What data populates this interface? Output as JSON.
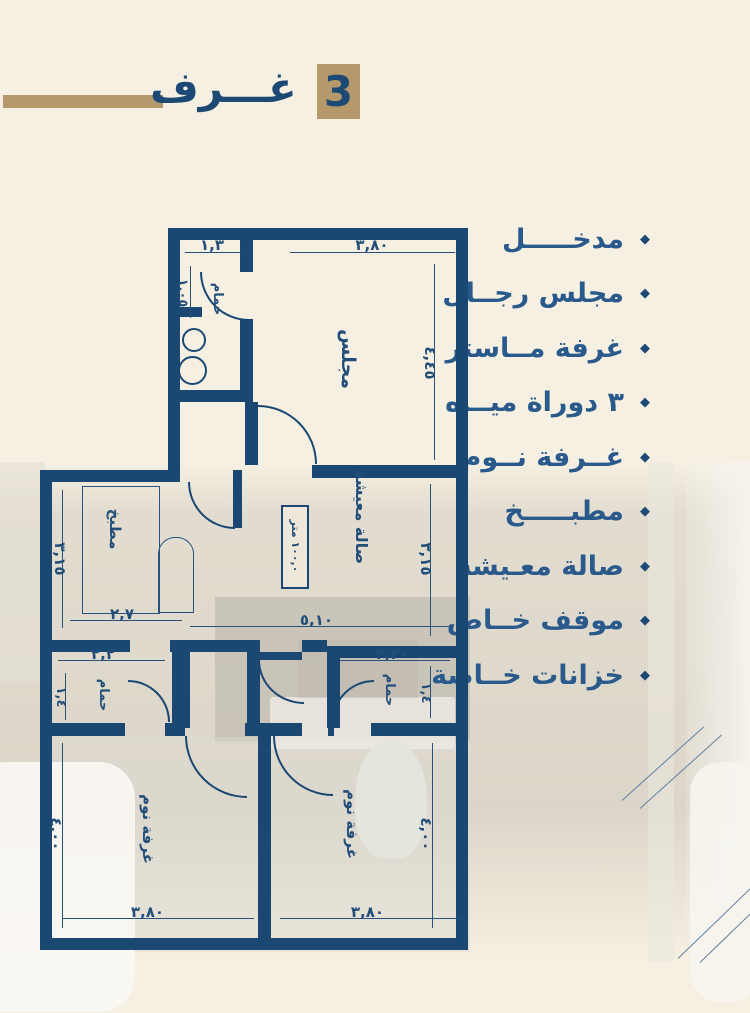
{
  "page": {
    "bg": "#f6f0e2",
    "accent_tan": "#b6996b",
    "navy": "#1d4a75"
  },
  "header": {
    "number": "3",
    "title": "غـــرف"
  },
  "features": [
    "مدخـــــل",
    "مجلس رجــال",
    "غرفة مــاستر",
    "٣ دوراة ميــاه",
    "غــرفة نــوم",
    "مطبـــــخ",
    "صالة معـيشة",
    "موقف خــاص",
    "خزانات خــاصة"
  ],
  "plan": {
    "rooms": {
      "majlis": "مجلس",
      "bath": "حمام",
      "kitchen": "مطبخ",
      "living": "صالة معيشة",
      "bedroom": "غرفة نوم",
      "area": "١٠٠,٠ متر"
    },
    "dims": {
      "majlis_w": "٣,٨٠",
      "majlis_h": "٤,٤٥",
      "bath_top_w": "١,٣",
      "bath_top_h": "١,٠٥",
      "kitchen_h": "٣,١٥",
      "kitchen_w": "٢,٧",
      "hall_w": "٥,١٠",
      "hall_h": "٣,١٥",
      "bath_left_w": "٢,٢",
      "bath_left_h": "١,٤",
      "bath_right_w": "٢,٣٠",
      "bath_right_h": "١,٤",
      "bed_left_w": "٣,٨٠",
      "bed_left_h": "٤,٠٠",
      "bed_right_w": "٣,٨٠",
      "bed_right_h": "٤,٠٠"
    }
  }
}
